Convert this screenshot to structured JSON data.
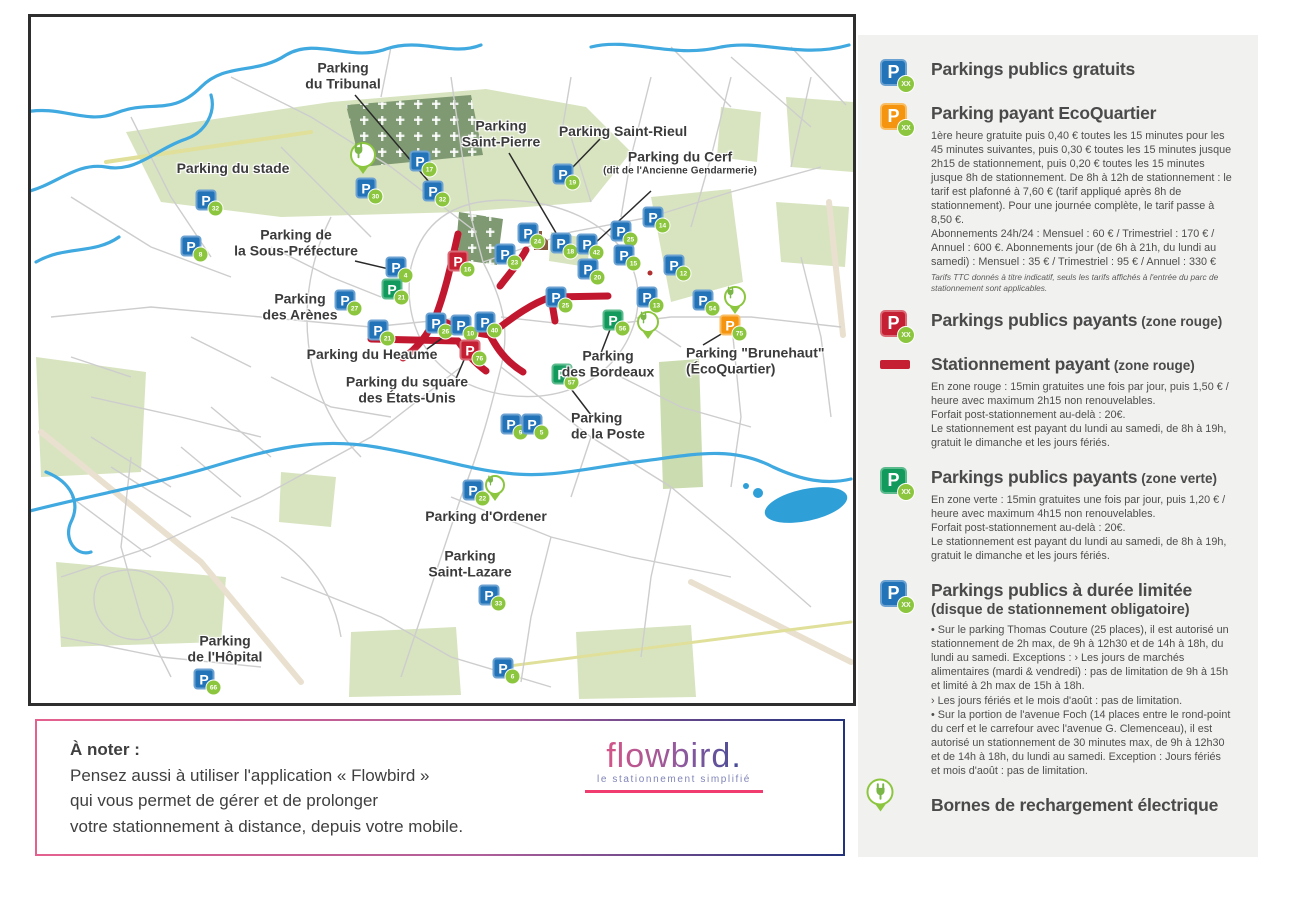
{
  "colors": {
    "blue_parking": "#2273b8",
    "orange_parking": "#f5940f",
    "red_parking": "#c51f33",
    "green_parking": "#12995c",
    "badge_green": "#8cc63e",
    "zone_line_red": "#c2182f",
    "river_blue": "#3fa9e0",
    "park_green": "#d8e4c0",
    "legend_bg": "#f1f1ef"
  },
  "legend": {
    "badge_placeholder": "xx",
    "items": [
      {
        "id": "free",
        "icon": "p-blue",
        "title": "Parkings publics gratuits"
      },
      {
        "id": "ecoquartier",
        "icon": "p-orange",
        "title": "Parking payant EcoQuartier",
        "body": [
          "1ère heure gratuite puis 0,40 € toutes les 15 minutes pour les 45 minutes suivantes, puis 0,30 € toutes les 15 minutes jusque 2h15 de stationnement, puis 0,20 € toutes les 15 minutes jusque 8h de stationnement. De 8h à 12h de stationnement : le tarif est plafonné à 7,60 € (tarif appliqué après 8h de stationnement). Pour une journée complète, le tarif passe à 8,50 €.",
          "Abonnements 24h/24 : Mensuel : 60 € / Trimestriel : 170 € / Annuel : 600 €. Abonnements jour (de 6h à 21h, du lundi au samedi) : Mensuel : 35 € / Trimestriel : 95 € / Annuel : 330 €"
        ],
        "fine_print": "Tarifs TTC donnés à titre indicatif, seuls les tarifs affichés à l'entrée du parc de stationnement sont applicables."
      },
      {
        "id": "paid-red",
        "icon": "p-red",
        "title": "Parkings publics payants",
        "suffix": "(zone rouge)"
      },
      {
        "id": "street-red",
        "icon": "red-line",
        "title": "Stationnement payant",
        "suffix": "(zone rouge)",
        "body": [
          "En zone rouge : 15min gratuites une fois par jour, puis 1,50 € / heure avec maximum 2h15 non renouvelables.",
          "Forfait post-stationnement au-delà : 20€.",
          "Le stationnement est payant du lundi au samedi, de 8h à 19h, gratuit le dimanche et les jours fériés."
        ]
      },
      {
        "id": "paid-green",
        "icon": "p-green",
        "title": "Parkings publics payants",
        "suffix": "(zone verte)",
        "body": [
          "En zone verte : 15min gratuites une fois par jour, puis 1,20 € / heure avec maximum 4h15 non renouvelables.",
          "Forfait post-stationnement au-delà : 20€.",
          "Le stationnement est payant du lundi au samedi, de 8h à 19h, gratuit le dimanche et les jours fériés."
        ]
      },
      {
        "id": "limited",
        "icon": "p-blue",
        "title": "Parkings publics à durée limitée",
        "subtitle": "(disque de stationnement obligatoire)",
        "body": [
          "• Sur le parking Thomas Couture (25 places), il est autorisé un stationnement de 2h max, de 9h à 12h30 et de 14h à 18h, du lundi au samedi. Exceptions : › Les jours de marchés alimentaires (mardi & vendredi) : pas de limitation de 9h à 15h et limité à 2h max de 15h à 18h.",
          "› Les jours fériés et le mois d'août : pas de limitation.",
          "• Sur la portion de l'avenue Foch (14 places entre le rond-point du cerf et le carrefour avec l'avenue G. Clemenceau), il est autorisé un stationnement de 30 minutes max, de 9h à 12h30 et de 14h à 18h, du lundi au samedi. Exception : Jours fériés et mois d'août : pas de limitation."
        ]
      },
      {
        "id": "charging",
        "icon": "charging",
        "title": "Bornes de rechargement électrique"
      }
    ]
  },
  "note": {
    "title": "À noter :",
    "lines": [
      "Pensez aussi à utiliser l'application « Flowbird »",
      "qui vous permet de gérer et de prolonger",
      "votre stationnement à distance, depuis votre mobile."
    ]
  },
  "logo": {
    "name": "flowbird.",
    "tagline": "le stationnement simplifié"
  },
  "map": {
    "labels": [
      {
        "id": "tribunal",
        "x": 312,
        "y": 59,
        "lines": [
          "Parking",
          "du Tribunal"
        ]
      },
      {
        "id": "stade",
        "x": 202,
        "y": 152,
        "lines": [
          "Parking du stade"
        ]
      },
      {
        "id": "saint-pierre",
        "x": 470,
        "y": 117,
        "lines": [
          "Parking",
          "Saint-Pierre"
        ]
      },
      {
        "id": "saint-rieul",
        "x": 592,
        "y": 115,
        "lines": [
          "Parking Saint-Rieul"
        ]
      },
      {
        "id": "cerf",
        "x": 649,
        "y": 146,
        "lines": [
          "Parking du Cerf"
        ],
        "sub": "(dit de l'Ancienne Gendarmerie)"
      },
      {
        "id": "sous-prefecture",
        "x": 265,
        "y": 226,
        "lines": [
          "Parking de",
          "la Sous-Préfecture"
        ]
      },
      {
        "id": "arenes",
        "x": 269,
        "y": 290,
        "lines": [
          "Parking",
          "des Arènes"
        ]
      },
      {
        "id": "heaume",
        "x": 341,
        "y": 338,
        "lines": [
          "Parking du Heaume"
        ]
      },
      {
        "id": "etats-unis",
        "x": 376,
        "y": 373,
        "lines": [
          "Parking du square",
          "des États-Unis"
        ]
      },
      {
        "id": "bordeaux",
        "x": 577,
        "y": 347,
        "lines": [
          "Parking",
          "des Bordeaux"
        ]
      },
      {
        "id": "brunehaut",
        "x": 655,
        "y": 344,
        "align": "left",
        "lines": [
          "Parking \"Brunehaut\"",
          "(ÉcoQuartier)"
        ]
      },
      {
        "id": "poste",
        "x": 540,
        "y": 409,
        "align": "left",
        "lines": [
          "Parking",
          "de la Poste"
        ]
      },
      {
        "id": "ordener",
        "x": 455,
        "y": 500,
        "lines": [
          "Parking d'Ordener"
        ]
      },
      {
        "id": "saint-lazare",
        "x": 439,
        "y": 547,
        "lines": [
          "Parking",
          "Saint-Lazare"
        ]
      },
      {
        "id": "hopital",
        "x": 194,
        "y": 632,
        "lines": [
          "Parking",
          "de l'Hôpital"
        ]
      }
    ],
    "markers": [
      {
        "type": "blue",
        "x": 175,
        "y": 183,
        "num": "32"
      },
      {
        "type": "blue",
        "x": 160,
        "y": 229,
        "num": "8"
      },
      {
        "type": "blue",
        "x": 335,
        "y": 171,
        "num": "30"
      },
      {
        "type": "blue",
        "x": 389,
        "y": 144,
        "num": "17"
      },
      {
        "type": "blue",
        "x": 402,
        "y": 174,
        "num": "32"
      },
      {
        "type": "blue",
        "x": 365,
        "y": 250,
        "num": "4"
      },
      {
        "type": "blue",
        "x": 314,
        "y": 283,
        "num": "27"
      },
      {
        "type": "blue",
        "x": 347,
        "y": 313,
        "num": "21"
      },
      {
        "type": "blue",
        "x": 405,
        "y": 306,
        "num": "26"
      },
      {
        "type": "blue",
        "x": 430,
        "y": 308,
        "num": "10"
      },
      {
        "type": "blue",
        "x": 454,
        "y": 305,
        "num": "40"
      },
      {
        "type": "blue",
        "x": 474,
        "y": 237,
        "num": "23"
      },
      {
        "type": "blue",
        "x": 497,
        "y": 216,
        "num": "24"
      },
      {
        "type": "blue",
        "x": 530,
        "y": 226,
        "num": "18"
      },
      {
        "type": "blue",
        "x": 556,
        "y": 227,
        "num": "42"
      },
      {
        "type": "blue",
        "x": 557,
        "y": 252,
        "num": "20"
      },
      {
        "type": "blue",
        "x": 525,
        "y": 280,
        "num": "25"
      },
      {
        "type": "blue",
        "x": 532,
        "y": 157,
        "num": "19"
      },
      {
        "type": "blue",
        "x": 590,
        "y": 214,
        "num": "25"
      },
      {
        "type": "blue",
        "x": 622,
        "y": 200,
        "num": "14"
      },
      {
        "type": "blue",
        "x": 593,
        "y": 238,
        "num": "15"
      },
      {
        "type": "blue",
        "x": 616,
        "y": 280,
        "num": "13"
      },
      {
        "type": "blue",
        "x": 672,
        "y": 283,
        "num": "54"
      },
      {
        "type": "blue",
        "x": 643,
        "y": 248,
        "num": "12"
      },
      {
        "type": "blue",
        "x": 480,
        "y": 407,
        "num": "9"
      },
      {
        "type": "blue",
        "x": 501,
        "y": 407,
        "num": "5"
      },
      {
        "type": "blue",
        "x": 442,
        "y": 473,
        "num": "22"
      },
      {
        "type": "blue",
        "x": 458,
        "y": 578,
        "num": "33"
      },
      {
        "type": "blue",
        "x": 472,
        "y": 651,
        "num": "6"
      },
      {
        "type": "blue",
        "x": 173,
        "y": 662,
        "num": "66"
      },
      {
        "type": "red",
        "x": 427,
        "y": 244,
        "num": "16"
      },
      {
        "type": "red",
        "x": 439,
        "y": 333,
        "num": "76"
      },
      {
        "type": "green",
        "x": 361,
        "y": 272,
        "num": "21"
      },
      {
        "type": "green",
        "x": 582,
        "y": 303,
        "num": "56"
      },
      {
        "type": "green",
        "x": 531,
        "y": 357,
        "num": "57"
      },
      {
        "type": "orange",
        "x": 699,
        "y": 308,
        "num": "75"
      }
    ],
    "charging": [
      {
        "x": 332,
        "y": 141,
        "size": 26
      },
      {
        "x": 704,
        "y": 283,
        "size": 22
      },
      {
        "x": 617,
        "y": 308,
        "size": 22
      },
      {
        "x": 464,
        "y": 471,
        "size": 20
      }
    ]
  }
}
